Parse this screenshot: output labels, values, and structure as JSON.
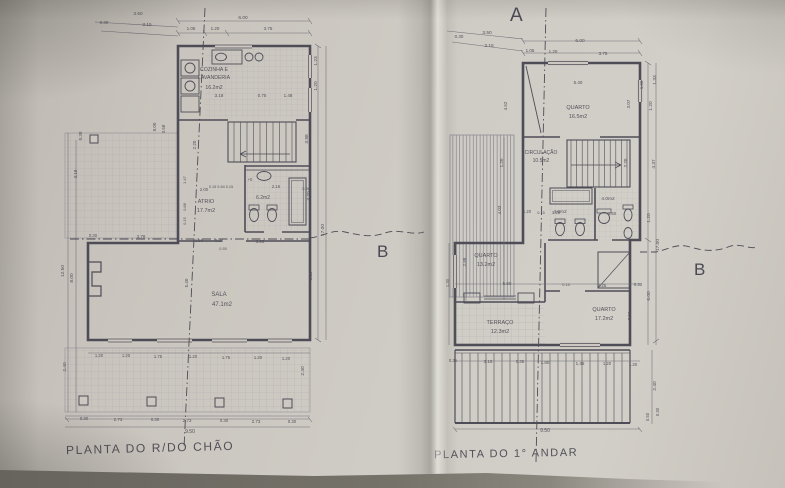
{
  "photo": {
    "paper_color": "#cdc9c2",
    "ink_color": "#4e4c56",
    "thin_line_color": "#6f6c77"
  },
  "left_plan": {
    "title": "PLANTA DO R/DO CHÃO",
    "section_b": "B",
    "rooms": [
      {
        "name": "COZINHA E LAVANDERIA",
        "area": "16.2m2"
      },
      {
        "name": "ATRIO",
        "area": "17.7m2"
      },
      {
        "name": "SALA",
        "area": "47.1m2"
      },
      {
        "name": "WC",
        "area": "6.2m2"
      }
    ],
    "annotations": [
      {
        "t": "3.50",
        "x": 138,
        "y": 15
      },
      {
        "t": "0.30",
        "x": 104,
        "y": 24,
        "s": 4.5
      },
      {
        "t": "3.15",
        "x": 147,
        "y": 26
      },
      {
        "t": "6.00",
        "x": 243,
        "y": 19
      },
      {
        "t": "1.05",
        "x": 191,
        "y": 30,
        "s": 4.5
      },
      {
        "t": "1.20",
        "x": 215,
        "y": 30,
        "s": 4.5
      },
      {
        "t": "3.75",
        "x": 268,
        "y": 30,
        "s": 4.5
      },
      {
        "t": "1.23",
        "x": 317,
        "y": 61,
        "r": -90
      },
      {
        "t": "1.20",
        "x": 317,
        "y": 86,
        "r": -90
      },
      {
        "t": "3.98",
        "x": 308,
        "y": 139,
        "r": -90
      },
      {
        "t": "3.20",
        "x": 310,
        "y": 196,
        "r": -90
      },
      {
        "t": "17.00",
        "x": 324,
        "y": 230,
        "r": -90
      },
      {
        "t": "6.39",
        "x": 312,
        "y": 276,
        "r": -90
      },
      {
        "t": "2.40",
        "x": 304,
        "y": 371,
        "r": -90
      },
      {
        "t": "0.30",
        "x": 82,
        "y": 136,
        "r": -90,
        "s": 4.5
      },
      {
        "t": "3.18",
        "x": 77,
        "y": 174,
        "r": -90,
        "s": 4.5
      },
      {
        "t": "12.50",
        "x": 64,
        "y": 271,
        "r": -90
      },
      {
        "t": "8.00",
        "x": 73,
        "y": 278,
        "r": -90
      },
      {
        "t": "8.00",
        "x": 156,
        "y": 127,
        "r": -90,
        "s": 4.5
      },
      {
        "t": "3.58",
        "x": 165,
        "y": 129,
        "r": -90,
        "s": 4.5
      },
      {
        "t": "2.20",
        "x": 196,
        "y": 145,
        "r": -90,
        "s": 4.5
      },
      {
        "t": "1.47",
        "x": 186,
        "y": 180,
        "r": -90,
        "s": 4
      },
      {
        "t": "0.88",
        "x": 186,
        "y": 207,
        "r": -90,
        "s": 4
      },
      {
        "t": "0.15",
        "x": 186,
        "y": 221,
        "r": -90,
        "s": 4
      },
      {
        "t": "COZINHA E",
        "x": 214,
        "y": 71,
        "s": 5.2
      },
      {
        "t": "LAVANDERIA",
        "x": 214,
        "y": 79,
        "s": 5.2
      },
      {
        "t": "16.2m2",
        "x": 214,
        "y": 89,
        "s": 5.2
      },
      {
        "t": "3.18",
        "x": 219,
        "y": 97,
        "s": 4.5
      },
      {
        "t": "0.75",
        "x": 262,
        "y": 97,
        "s": 4.5
      },
      {
        "t": "1.48",
        "x": 288,
        "y": 97,
        "s": 4.5
      },
      {
        "t": "0.15 0.84 0.15",
        "x": 221,
        "y": 188,
        "s": 3.8
      },
      {
        "t": "2.16",
        "x": 276,
        "y": 188,
        "s": 4.2
      },
      {
        "t": "0.36",
        "x": 306,
        "y": 190,
        "s": 3.8
      },
      {
        "t": "2.00",
        "x": 204,
        "y": 191,
        "s": 4.2
      },
      {
        "t": "+0",
        "x": 250,
        "y": 181,
        "s": 4.2
      },
      {
        "t": "6.2m2",
        "x": 263,
        "y": 199,
        "s": 5
      },
      {
        "t": "ATRIO",
        "x": 206,
        "y": 203,
        "s": 5.5
      },
      {
        "t": "17.7m2",
        "x": 206,
        "y": 212,
        "s": 5.5
      },
      {
        "t": "0.30",
        "x": 93,
        "y": 237,
        "s": 4.2
      },
      {
        "t": "3.78",
        "x": 141,
        "y": 238,
        "s": 4.5
      },
      {
        "t": "1.50",
        "x": 199,
        "y": 242,
        "s": 4.2
      },
      {
        "t": "0.24",
        "x": 219,
        "y": 242,
        "s": 4.2
      },
      {
        "t": "0.55",
        "x": 223,
        "y": 250,
        "s": 3.8
      },
      {
        "t": "3.25",
        "x": 260,
        "y": 243,
        "s": 4.5
      },
      {
        "t": "5.40",
        "x": 188,
        "y": 283,
        "r": -90,
        "s": 4.5
      },
      {
        "t": "SALA",
        "x": 219,
        "y": 296,
        "s": 6
      },
      {
        "t": "47.1m2",
        "x": 222,
        "y": 306,
        "s": 6
      },
      {
        "t": "1.20",
        "x": 99,
        "y": 357,
        "s": 4.2
      },
      {
        "t": "1.20",
        "x": 126,
        "y": 357,
        "s": 4.2
      },
      {
        "t": "1.75",
        "x": 158,
        "y": 358,
        "s": 4.2
      },
      {
        "t": "1.20",
        "x": 193,
        "y": 358,
        "s": 4.2
      },
      {
        "t": "1.75",
        "x": 226,
        "y": 359,
        "s": 4.2
      },
      {
        "t": "1.20",
        "x": 258,
        "y": 359,
        "s": 4.2
      },
      {
        "t": "1.20",
        "x": 286,
        "y": 360,
        "s": 4.2
      },
      {
        "t": "2.40",
        "x": 66,
        "y": 367,
        "r": -90
      },
      {
        "t": "0.30",
        "x": 84,
        "y": 420,
        "s": 4.2
      },
      {
        "t": "2.73",
        "x": 118,
        "y": 421,
        "s": 4.5
      },
      {
        "t": "0.30",
        "x": 155,
        "y": 421,
        "s": 4.2
      },
      {
        "t": "2.73",
        "x": 187,
        "y": 422,
        "s": 4.5
      },
      {
        "t": "0.30",
        "x": 224,
        "y": 422,
        "s": 4.2
      },
      {
        "t": "2.73",
        "x": 256,
        "y": 423,
        "s": 4.5
      },
      {
        "t": "0.30",
        "x": 292,
        "y": 423,
        "s": 4.2
      },
      {
        "t": "9.50",
        "x": 190,
        "y": 433,
        "s": 5
      }
    ]
  },
  "right_plan": {
    "title": "PLANTA DO 1° ANDAR",
    "section_a": "A",
    "section_b": "B",
    "rooms": [
      {
        "name": "QUARTO",
        "area": "16.5m2"
      },
      {
        "name": "CIRCULAÇÃO",
        "area": "10.5m2"
      },
      {
        "name": "QUARTO",
        "area": "13.2m2"
      },
      {
        "name": "TERRAÇO",
        "area": "12.3m2"
      },
      {
        "name": "QUARTO",
        "area": "17.2m2"
      },
      {
        "name": "WC",
        "area": "4.0m2"
      },
      {
        "name": "WC",
        "area": "4.0m2"
      }
    ],
    "annotations": [
      {
        "t": "3.50",
        "x": 487,
        "y": 34
      },
      {
        "t": "0.30",
        "x": 459,
        "y": 38,
        "s": 4.5
      },
      {
        "t": "3.15",
        "x": 489,
        "y": 47
      },
      {
        "t": "6.00",
        "x": 580,
        "y": 42
      },
      {
        "t": "1.05",
        "x": 530,
        "y": 52,
        "s": 4.5
      },
      {
        "t": "1.20",
        "x": 553,
        "y": 53,
        "s": 4.5
      },
      {
        "t": "3.75",
        "x": 603,
        "y": 55,
        "s": 4.5
      },
      {
        "t": "5.40",
        "x": 578,
        "y": 84,
        "s": 4.5
      },
      {
        "t": "1.30",
        "x": 643,
        "y": 85,
        "r": -90,
        "s": 4.2
      },
      {
        "t": "1.33",
        "x": 656,
        "y": 80,
        "r": -90
      },
      {
        "t": "1.20",
        "x": 652,
        "y": 106,
        "r": -90
      },
      {
        "t": "3.07",
        "x": 630,
        "y": 104,
        "r": -90,
        "s": 4.5
      },
      {
        "t": "2.20",
        "x": 627,
        "y": 163,
        "r": -90,
        "s": 4.5
      },
      {
        "t": "4.37",
        "x": 655,
        "y": 164,
        "r": -90
      },
      {
        "t": "1.20",
        "x": 650,
        "y": 218,
        "r": -90
      },
      {
        "t": "17.00",
        "x": 659,
        "y": 245,
        "r": -90
      },
      {
        "t": "6.00",
        "x": 650,
        "y": 296,
        "r": -90
      },
      {
        "t": "3.56",
        "x": 631,
        "y": 316,
        "r": -90,
        "s": 4.5
      },
      {
        "t": "2.40",
        "x": 656,
        "y": 386,
        "r": -90
      },
      {
        "t": "0.50",
        "x": 649,
        "y": 417,
        "r": -90,
        "s": 4.2
      },
      {
        "t": "0.30",
        "x": 659,
        "y": 412,
        "r": -90,
        "s": 4.2
      },
      {
        "t": "4.52",
        "x": 507,
        "y": 106,
        "r": -90,
        "s": 4.5
      },
      {
        "t": "1.20",
        "x": 503,
        "y": 163,
        "r": -90,
        "s": 4.5
      },
      {
        "t": "4.03",
        "x": 501,
        "y": 210,
        "r": -90,
        "s": 4.5
      },
      {
        "t": "2.88",
        "x": 466,
        "y": 262,
        "r": -90,
        "s": 4.5
      },
      {
        "t": "1.30",
        "x": 449,
        "y": 283,
        "r": -90,
        "s": 4.2
      },
      {
        "t": "QUARTO",
        "x": 578,
        "y": 109,
        "s": 5.5
      },
      {
        "t": "16.5m2",
        "x": 578,
        "y": 118,
        "s": 5.5
      },
      {
        "t": "CIRCULAÇÃO",
        "x": 541,
        "y": 154,
        "s": 5
      },
      {
        "t": "10.5m2",
        "x": 541,
        "y": 162,
        "s": 5
      },
      {
        "t": "4.0m2",
        "x": 560,
        "y": 213,
        "s": 4.8
      },
      {
        "t": "4.0m2",
        "x": 608,
        "y": 200,
        "s": 4.8
      },
      {
        "t": "1.20",
        "x": 527,
        "y": 213,
        "s": 4.2
      },
      {
        "t": "0.15",
        "x": 541,
        "y": 214,
        "s": 3.8
      },
      {
        "t": "1.25",
        "x": 556,
        "y": 214,
        "s": 4.2
      },
      {
        "t": "1.50",
        "x": 612,
        "y": 215,
        "s": 4.2
      },
      {
        "t": "QUARTO",
        "x": 486,
        "y": 257,
        "s": 5.5
      },
      {
        "t": "13.2m2",
        "x": 486,
        "y": 266,
        "s": 5.5
      },
      {
        "t": "5.50",
        "x": 507,
        "y": 285,
        "s": 4.5
      },
      {
        "t": "0.15",
        "x": 566,
        "y": 286,
        "s": 3.8
      },
      {
        "t": "3.25",
        "x": 602,
        "y": 287,
        "s": 4.5
      },
      {
        "t": "0.30",
        "x": 638,
        "y": 286,
        "s": 4.2
      },
      {
        "t": "TERRAÇO",
        "x": 500,
        "y": 324,
        "s": 5.5
      },
      {
        "t": "12.3m2",
        "x": 500,
        "y": 333,
        "s": 5.5
      },
      {
        "t": "QUARTO",
        "x": 604,
        "y": 311,
        "s": 5.5
      },
      {
        "t": "17.2m2",
        "x": 604,
        "y": 320,
        "s": 5.5
      },
      {
        "t": "0.35",
        "x": 453,
        "y": 362,
        "s": 4.2
      },
      {
        "t": "3.15",
        "x": 488,
        "y": 363,
        "s": 4.5
      },
      {
        "t": "0.35",
        "x": 520,
        "y": 363,
        "s": 4.2
      },
      {
        "t": "1.80",
        "x": 545,
        "y": 364,
        "s": 4.5
      },
      {
        "t": "1.45",
        "x": 580,
        "y": 365,
        "s": 4.5
      },
      {
        "t": "1.20",
        "x": 607,
        "y": 365,
        "s": 4.2
      },
      {
        "t": "1.20",
        "x": 633,
        "y": 366,
        "s": 4.2
      },
      {
        "t": "9.50",
        "x": 545,
        "y": 432,
        "s": 5
      }
    ]
  }
}
